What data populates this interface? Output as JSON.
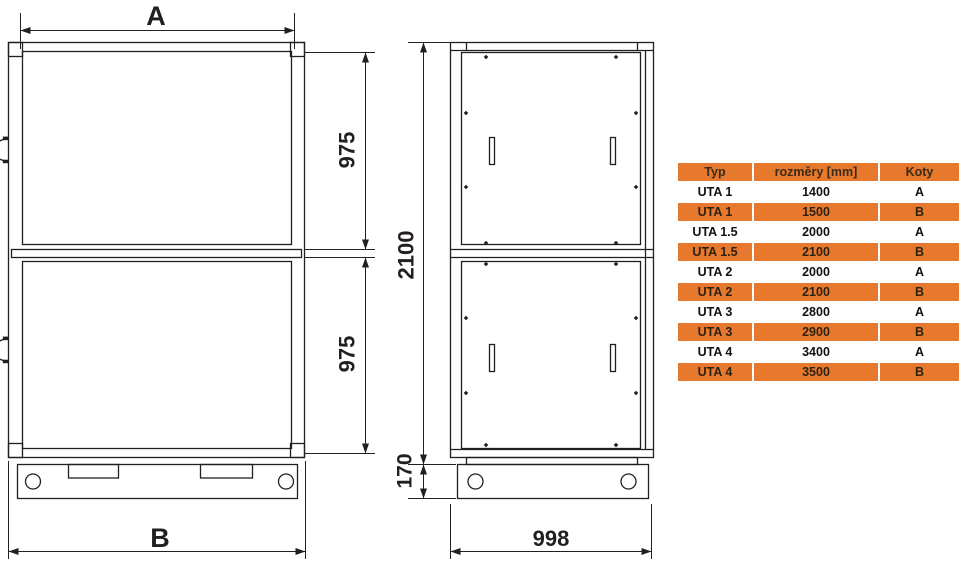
{
  "drawing": {
    "front_view": {
      "width_top_label": "A",
      "width_bottom_label": "B",
      "upper_section_height": "975",
      "lower_section_height": "975"
    },
    "side_view": {
      "body_height": "2100",
      "base_height": "170",
      "depth": "998"
    }
  },
  "table": {
    "headers": {
      "typ": "Typ",
      "rozmery": "rozměry [mm]",
      "koty": "Koty"
    },
    "rows": [
      {
        "typ": "UTA 1",
        "rozmery": "1400",
        "koty": "A"
      },
      {
        "typ": "UTA 1",
        "rozmery": "1500",
        "koty": "B"
      },
      {
        "typ": "UTA 1.5",
        "rozmery": "2000",
        "koty": "A"
      },
      {
        "typ": "UTA 1.5",
        "rozmery": "2100",
        "koty": "B"
      },
      {
        "typ": "UTA 2",
        "rozmery": "2000",
        "koty": "A"
      },
      {
        "typ": "UTA 2",
        "rozmery": "2100",
        "koty": "B"
      },
      {
        "typ": "UTA 3",
        "rozmery": "2800",
        "koty": "A"
      },
      {
        "typ": "UTA 3",
        "rozmery": "2900",
        "koty": "B"
      },
      {
        "typ": "UTA 4",
        "rozmery": "3400",
        "koty": "A"
      },
      {
        "typ": "UTA 4",
        "rozmery": "3500",
        "koty": "B"
      }
    ]
  },
  "colors": {
    "line": "#231F20",
    "table_orange": "#E6792E",
    "background": "#FFFFFF"
  }
}
